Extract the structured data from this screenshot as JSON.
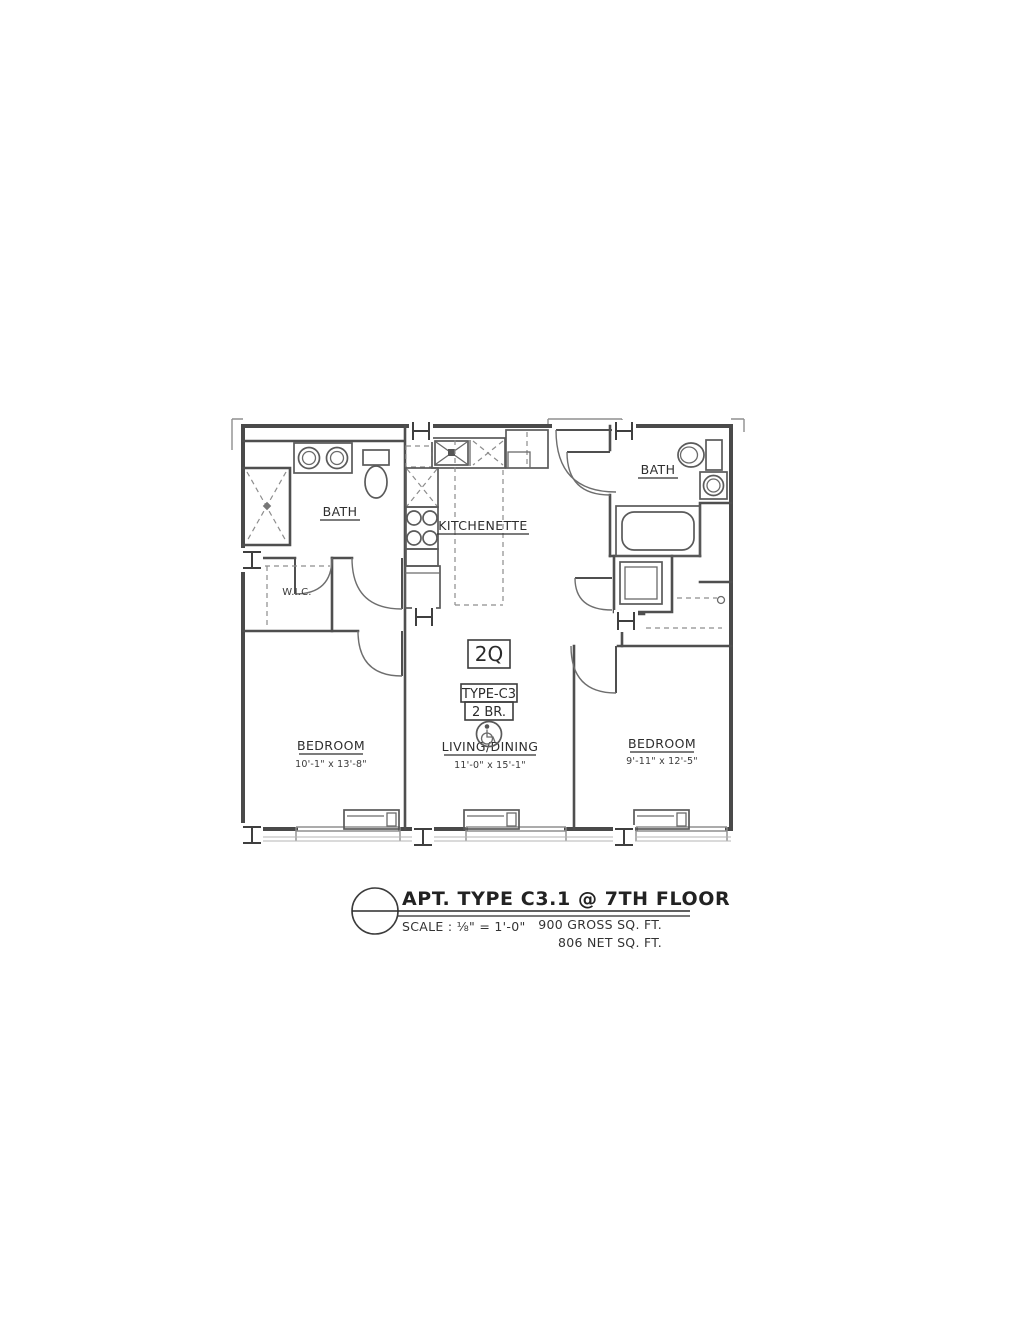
{
  "plan": {
    "rooms": {
      "bath_left": {
        "label": "BATH"
      },
      "kitchenette": {
        "label": "KITCHENETTE"
      },
      "bath_right": {
        "label": "BATH"
      },
      "wic": {
        "label": "W.I.C."
      },
      "bedroom_left": {
        "label": "BEDROOM",
        "dimensions": "10'-1\" x 13'-8\""
      },
      "living_dining": {
        "label": "LIVING/DINING",
        "dimensions": "11'-0\" x 15'-1\""
      },
      "bedroom_right": {
        "label": "BEDROOM",
        "dimensions": "9'-11\" x 12'-5\""
      }
    },
    "markers": {
      "bed_config": "2Q",
      "unit_type": "TYPE-C3",
      "bedroom_count": "2 BR."
    },
    "icons": {
      "accessible": "wheelchair-accessible-icon",
      "door_tag": "H",
      "window_tag": "I"
    }
  },
  "title_block": {
    "title": "APT. TYPE C3.1 @ 7TH FLOOR",
    "scale": "SCALE : ⅛\" = 1'-0\"",
    "gross_area": "900 GROSS SQ. FT.",
    "net_area": "806 NET SQ. FT."
  },
  "colors": {
    "line": "#4a4a4a",
    "text": "#2e2e2e",
    "paper": "#ffffff"
  }
}
